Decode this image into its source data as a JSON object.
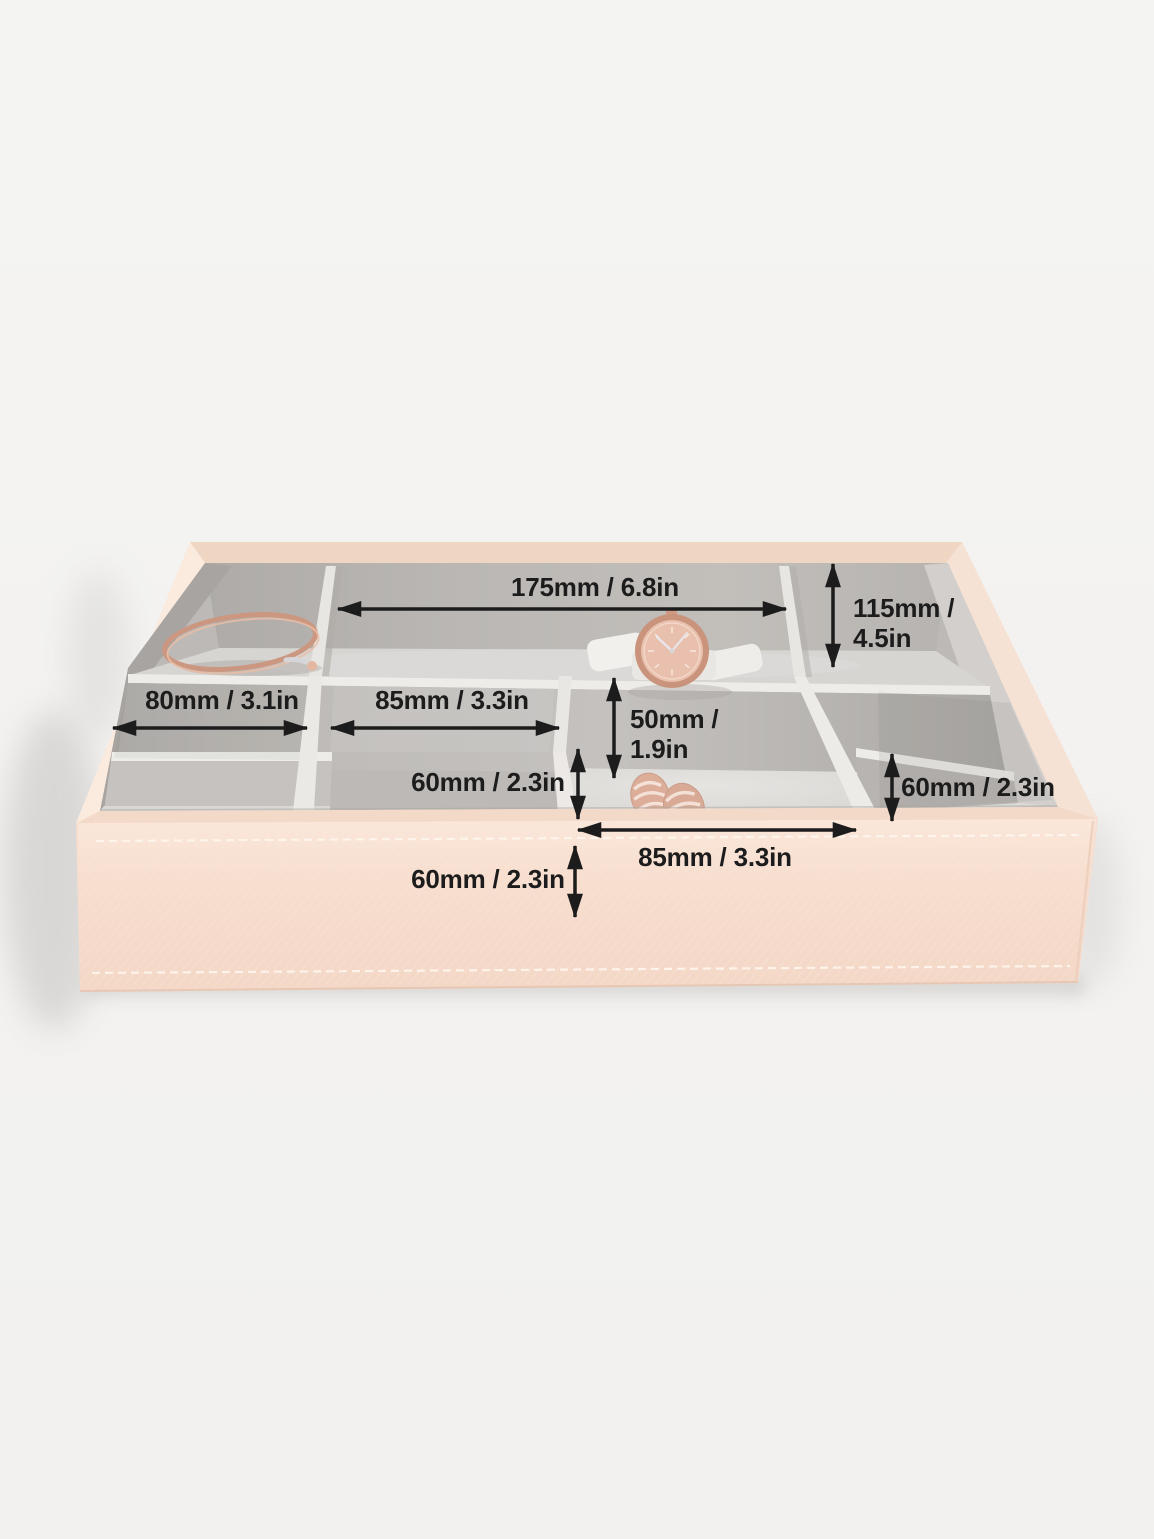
{
  "scene": {
    "background_color": "#f3f2f0",
    "annotation_color": "#1c1c1c",
    "tray_shell_color": "#f7ddcd",
    "tray_rim_color": "#eed6c2",
    "lining_color": "#bcb9b6",
    "divider_edge_color": "#edece9",
    "items": [
      "bangle",
      "watch",
      "cufflinks"
    ]
  },
  "annotations": [
    {
      "id": "back-compartment-width",
      "text": "175mm / 6.8in",
      "value_mm": 175,
      "value_in": 6.8
    },
    {
      "id": "back-compartment-depth",
      "text": "115mm / 4.5in",
      "line1": "115mm /",
      "line2": "4.5in",
      "value_mm": 115,
      "value_in": 4.5
    },
    {
      "id": "left-compartment-width",
      "text": "80mm / 3.1in",
      "value_mm": 80,
      "value_in": 3.1
    },
    {
      "id": "middle-compartment-width",
      "text": "85mm / 3.3in",
      "value_mm": 85,
      "value_in": 3.3
    },
    {
      "id": "centre-compartment-depth",
      "text": "50mm / 1.9in",
      "line1": "50mm /",
      "line2": "1.9in",
      "value_mm": 50,
      "value_in": 1.9
    },
    {
      "id": "centre-divider-height",
      "text": "60mm / 2.3in",
      "value_mm": 60,
      "value_in": 2.3
    },
    {
      "id": "right-divider-height",
      "text": "60mm / 2.3in",
      "value_mm": 60,
      "value_in": 2.3
    },
    {
      "id": "front-compartment-width",
      "text": "85mm / 3.3in",
      "value_mm": 85,
      "value_in": 3.3
    },
    {
      "id": "tray-height",
      "text": "60mm / 2.3in",
      "value_mm": 60,
      "value_in": 2.3
    }
  ]
}
